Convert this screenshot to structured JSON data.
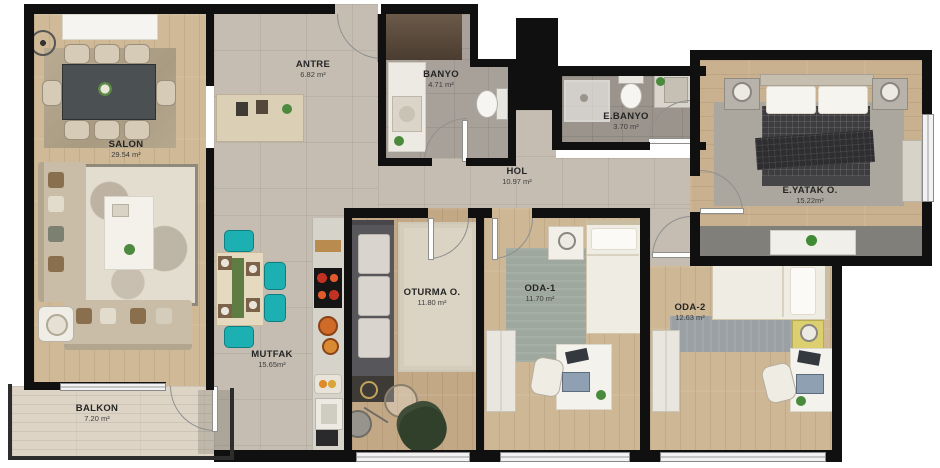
{
  "palette": {
    "wall": "#101010",
    "wood": "#cdb795",
    "tile": "#c5bdb1",
    "accent_teal": "#1db0b2",
    "armchair_green": "#31402b",
    "nightstand_yellow": "#dbcf70",
    "stove_red": "#d43b25"
  },
  "rooms": {
    "salon": {
      "name": "SALON",
      "area": "29.54 m²"
    },
    "antre": {
      "name": "ANTRE",
      "area": "6.82 m²"
    },
    "banyo": {
      "name": "BANYO",
      "area": "4.71 m²"
    },
    "ebanyo": {
      "name": "E.BANYO",
      "area": "3.70 m²"
    },
    "hol": {
      "name": "HOL",
      "area": "10.97 m²"
    },
    "eyatak": {
      "name": "E.YATAK O.",
      "area": "15.22m²"
    },
    "oturma": {
      "name": "OTURMA O.",
      "area": "11.80 m²"
    },
    "oda1": {
      "name": "ODA-1",
      "area": "11.70 m²"
    },
    "oda2": {
      "name": "ODA-2",
      "area": "12.63 m²"
    },
    "mutfak": {
      "name": "MUTFAK",
      "area": "15.65m²"
    },
    "balkon": {
      "name": "BALKON",
      "area": "7.20 m²"
    }
  }
}
